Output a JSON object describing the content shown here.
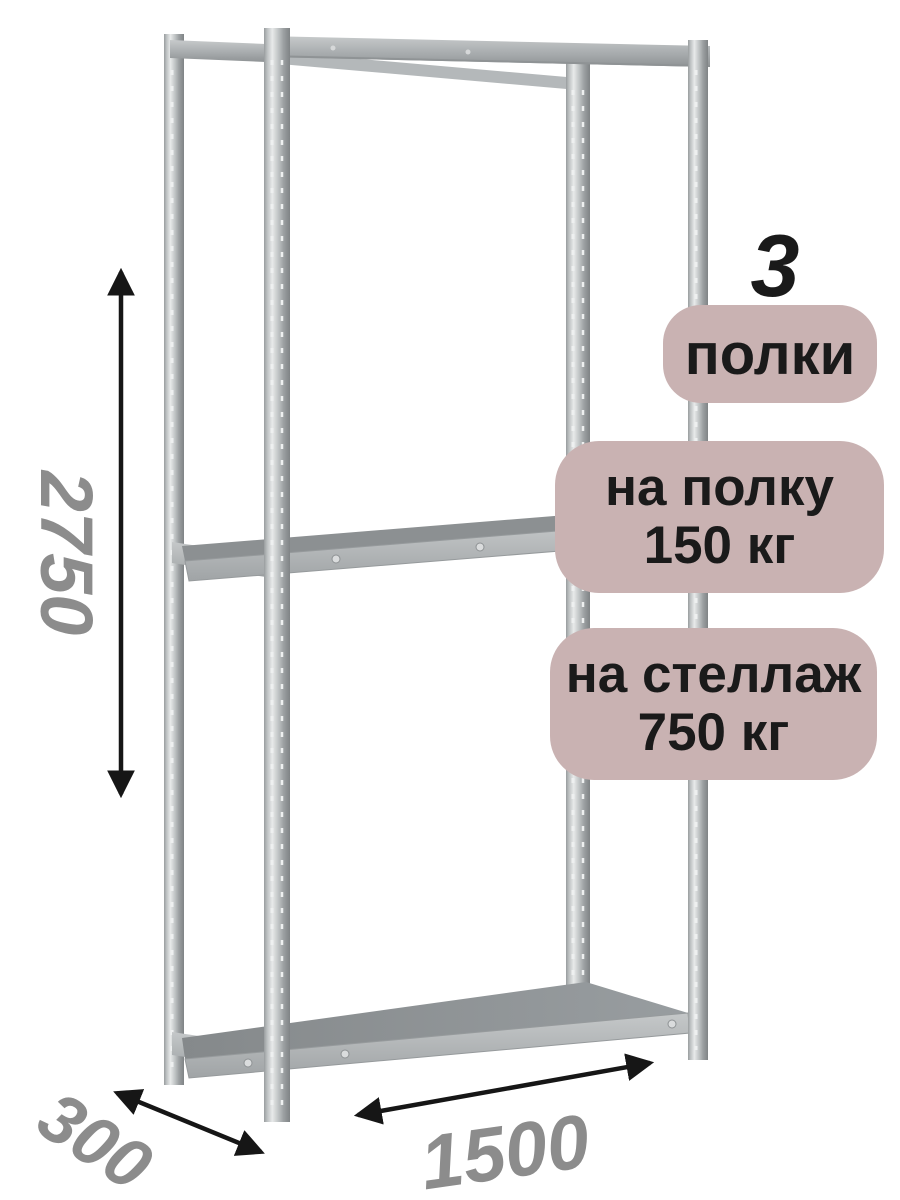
{
  "badges": {
    "count_number": "3",
    "count_label": "полки",
    "per_shelf_line1": "на полку",
    "per_shelf_line2": "150 кг",
    "per_rack_line1": "на стеллаж",
    "per_rack_line2": "750 кг"
  },
  "dimensions": {
    "height": "2750",
    "depth": "300",
    "width": "1500"
  },
  "rack": {
    "shelf_count": 3,
    "visible_shelves": [
      "top",
      "middle",
      "bottom"
    ]
  },
  "colors": {
    "background": "#ffffff",
    "badge_background": "#c9b2b2",
    "badge_text": "#1a1a1a",
    "dimension_text": "#8c8c8c",
    "arrow": "#161616",
    "metal_light": "#e6e8e8",
    "metal_mid": "#aaaeb0",
    "metal_dark": "#8c9092"
  }
}
